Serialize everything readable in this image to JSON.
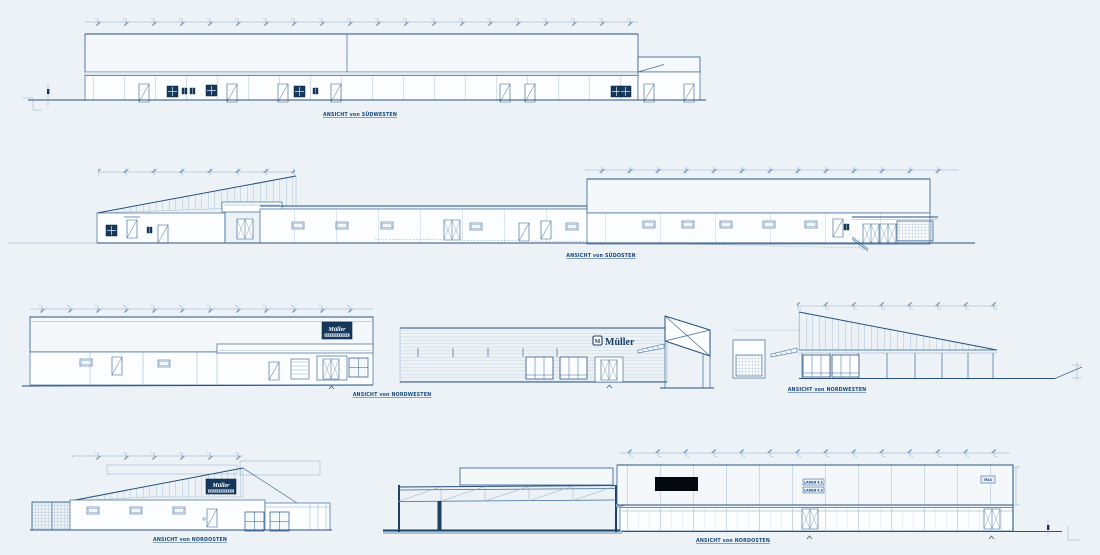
{
  "drawing": {
    "background": "#edf2f6",
    "line_color": "#3c6b99",
    "dark_navy": "#16375c",
    "views": [
      {
        "id": "suedwesten",
        "label": "ANSICHT von SÜDWESTEN"
      },
      {
        "id": "suedosten",
        "label": "ANSICHT von SÜDOSTEN"
      },
      {
        "id": "nordwesten-mueller",
        "label": "ANSICHT von NORDWESTEN"
      },
      {
        "id": "nordwesten-pultdach",
        "label": "ANSICHT von NORDWESTEN"
      },
      {
        "id": "nordosten-mueller",
        "label": "ANSICHT von NORDOSTEN"
      },
      {
        "id": "nordosten-laeden",
        "label": "ANSICHT von NORDOSTEN"
      }
    ],
    "signs": {
      "mueller_wordmark": "Müller",
      "mueller_emblem": "M",
      "facade_sign_script": "Müller",
      "laden_1": "LADEN 4.1",
      "laden_2": "LADEN 4.2",
      "unit_box": "M24"
    }
  }
}
